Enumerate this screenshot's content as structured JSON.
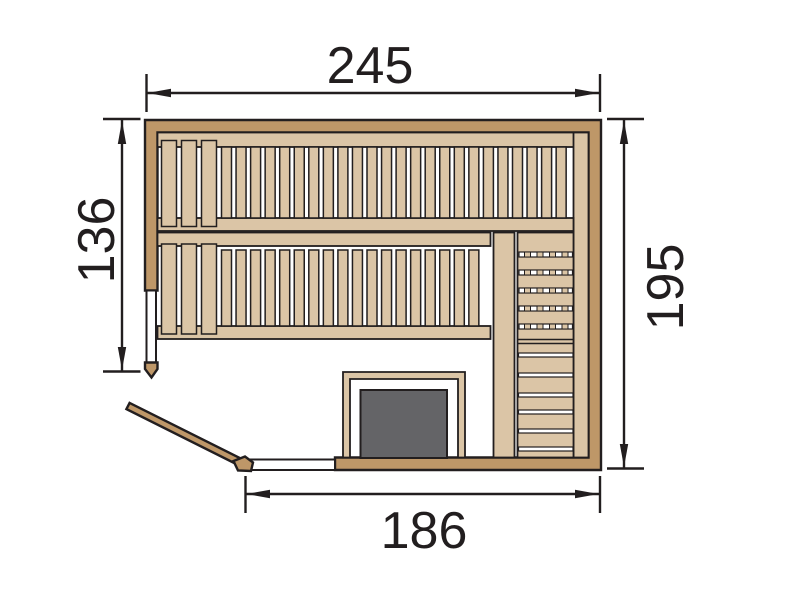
{
  "title": "Sauna floor plan with dimensions",
  "units_note": "",
  "colors": {
    "outline": "#221E1F",
    "wood": "#BE9768",
    "wood_light": "#DBC5A6",
    "heater": "#646467",
    "glass": "#FFFFFF",
    "background": "#FFFFFF"
  },
  "dimensions": {
    "top": {
      "value": "245"
    },
    "left": {
      "value": "136"
    },
    "right": {
      "value": "195"
    },
    "bottom": {
      "value": "186"
    }
  },
  "structure": {
    "upper_bench": {
      "wide_slats": 3,
      "narrow_slats": 24
    },
    "lower_bench": {
      "wide_slats": 3,
      "narrow_slats": 18
    },
    "side_bench": {
      "dashed_rows": 5,
      "plank_rows": 6
    },
    "heater": "stove with guard rail",
    "door": "corner glass door shown open"
  }
}
